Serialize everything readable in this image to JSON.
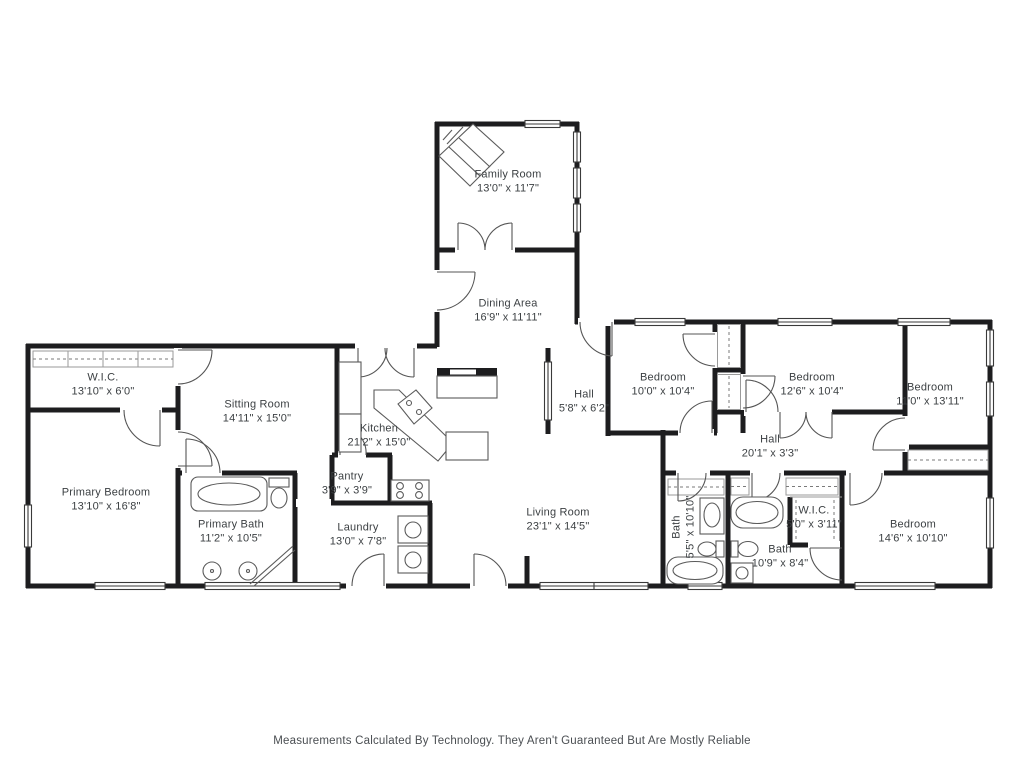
{
  "meta": {
    "footer": "Measurements Calculated By Technology. They Aren't Guaranteed But Are Mostly Reliable",
    "wall_color": "#1d1d1f",
    "label_color": "#3c4043"
  },
  "rooms": [
    {
      "id": "family-room",
      "name": "Family Room",
      "dims": "13'0\" x 11'7\"",
      "x": 508,
      "y": 182,
      "rotate": 0
    },
    {
      "id": "dining-area",
      "name": "Dining Area",
      "dims": "16'9\" x 11'11\"",
      "x": 508,
      "y": 311,
      "rotate": 0
    },
    {
      "id": "wic-primary",
      "name": "W.I.C.",
      "dims": "13'10\" x 6'0\"",
      "x": 103,
      "y": 385,
      "rotate": 0
    },
    {
      "id": "sitting-room",
      "name": "Sitting Room",
      "dims": "14'11\" x 15'0\"",
      "x": 257,
      "y": 412,
      "rotate": 0
    },
    {
      "id": "kitchen",
      "name": "Kitchen",
      "dims": "21'2\" x 15'0\"",
      "x": 379,
      "y": 436,
      "rotate": 0
    },
    {
      "id": "hall-small",
      "name": "Hall",
      "dims": "5'8\" x 6'2\"",
      "x": 584,
      "y": 402,
      "rotate": 0
    },
    {
      "id": "bedroom-1",
      "name": "Bedroom",
      "dims": "10'0\" x 10'4\"",
      "x": 663,
      "y": 385,
      "rotate": 0
    },
    {
      "id": "bedroom-2",
      "name": "Bedroom",
      "dims": "12'6\" x 10'4\"",
      "x": 812,
      "y": 385,
      "rotate": 0
    },
    {
      "id": "bedroom-3",
      "name": "Bedroom",
      "dims": "11'0\" x 13'11\"",
      "x": 930,
      "y": 395,
      "rotate": 0
    },
    {
      "id": "primary-bedroom",
      "name": "Primary Bedroom",
      "dims": "13'10\" x 16'8\"",
      "x": 106,
      "y": 500,
      "rotate": 0
    },
    {
      "id": "primary-bath",
      "name": "Primary Bath",
      "dims": "11'2\" x 10'5\"",
      "x": 231,
      "y": 532,
      "rotate": 0
    },
    {
      "id": "pantry",
      "name": "Pantry",
      "dims": "3'9\" x 3'9\"",
      "x": 347,
      "y": 484,
      "rotate": 0
    },
    {
      "id": "laundry",
      "name": "Laundry",
      "dims": "13'0\" x 7'8\"",
      "x": 358,
      "y": 535,
      "rotate": 0
    },
    {
      "id": "living-room",
      "name": "Living Room",
      "dims": "23'1\" x 14'5\"",
      "x": 558,
      "y": 520,
      "rotate": 0
    },
    {
      "id": "hall-long",
      "name": "Hall",
      "dims": "20'1\" x 3'3\"",
      "x": 770,
      "y": 447,
      "rotate": 0
    },
    {
      "id": "bath-1",
      "name": "Bath",
      "dims": "5'5\" x 10'10\"",
      "x": 684,
      "y": 527,
      "rotate": -90
    },
    {
      "id": "wic-2",
      "name": "W.I.C.",
      "dims": "5'0\" x 3'11\"",
      "x": 814,
      "y": 518,
      "rotate": 0
    },
    {
      "id": "bath-2",
      "name": "Bath",
      "dims": "10'9\" x 8'4\"",
      "x": 780,
      "y": 557,
      "rotate": 0
    },
    {
      "id": "bedroom-4",
      "name": "Bedroom",
      "dims": "14'6\" x 10'10\"",
      "x": 913,
      "y": 532,
      "rotate": 0
    }
  ]
}
